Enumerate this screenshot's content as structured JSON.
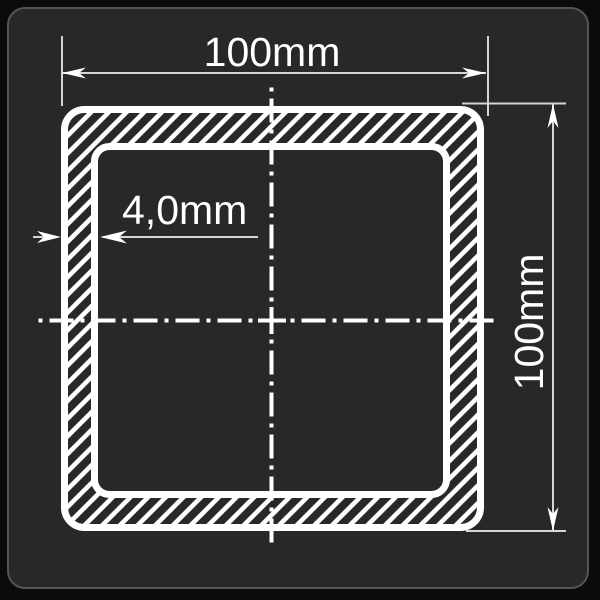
{
  "drawing": {
    "type": "square-hollow-section-cross-section",
    "outer_width_dimension": {
      "label": "100mm"
    },
    "outer_height_dimension": {
      "label": "100mm"
    },
    "wall_thickness_dimension": {
      "label": "4,0mm"
    }
  },
  "colors": {
    "background": "#0b0b0b",
    "panel": "#282828",
    "panel_border": "#555555",
    "profile_line": "#ffffff",
    "dimension_line": "#d6d6d6",
    "text": "#ffffff"
  }
}
